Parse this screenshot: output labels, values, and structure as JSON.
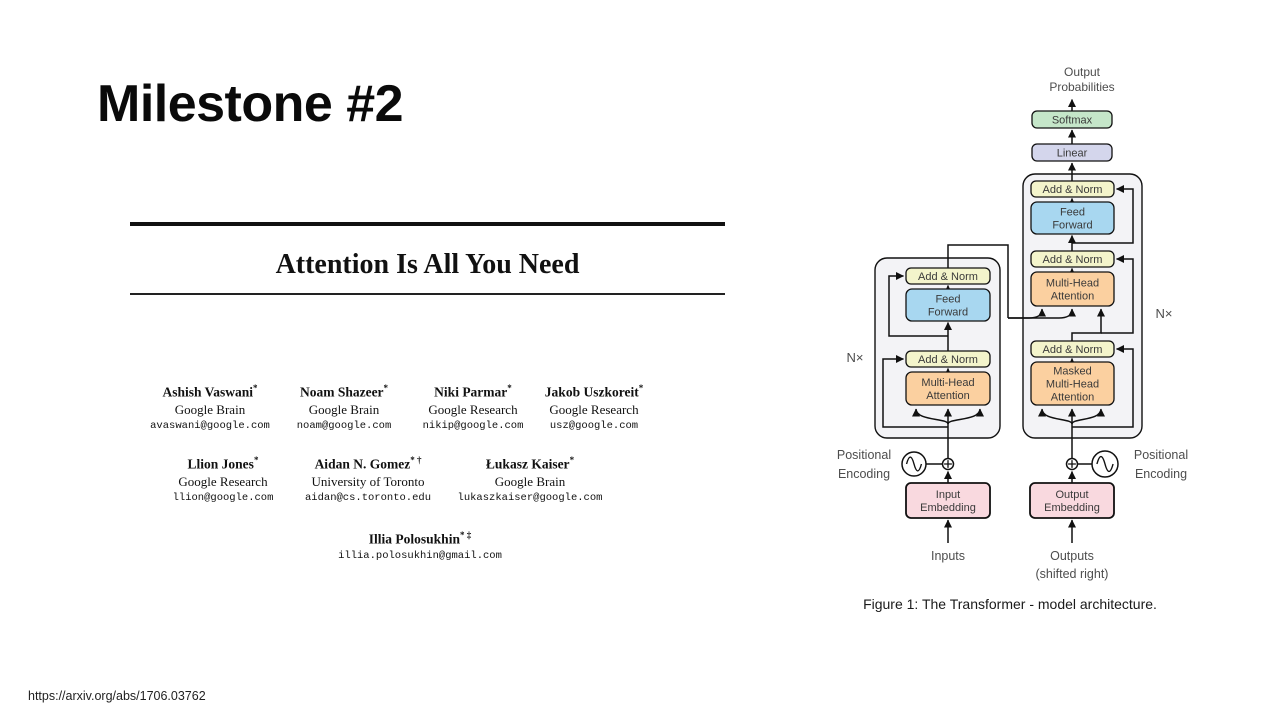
{
  "slide": {
    "title": "Milestone #2",
    "source_url": "https://arxiv.org/abs/1706.03762"
  },
  "paper": {
    "title": "Attention Is All You Need",
    "author_rows": [
      {
        "top": 158,
        "authors": [
          {
            "cx": 80,
            "name": "Ashish Vaswani",
            "sup": "*",
            "affiliation": "Google Brain",
            "email": "avaswani@google.com"
          },
          {
            "cx": 214,
            "name": "Noam Shazeer",
            "sup": "*",
            "affiliation": "Google Brain",
            "email": "noam@google.com"
          },
          {
            "cx": 343,
            "name": "Niki Parmar",
            "sup": "*",
            "affiliation": "Google Research",
            "email": "nikip@google.com"
          },
          {
            "cx": 464,
            "name": "Jakob Uszkoreit",
            "sup": "*",
            "affiliation": "Google Research",
            "email": "usz@google.com"
          }
        ]
      },
      {
        "top": 230,
        "authors": [
          {
            "cx": 93,
            "name": "Llion Jones",
            "sup": "*",
            "affiliation": "Google Research",
            "email": "llion@google.com"
          },
          {
            "cx": 238,
            "name": "Aidan N. Gomez",
            "sup": "* †",
            "affiliation": "University of Toronto",
            "email": "aidan@cs.toronto.edu"
          },
          {
            "cx": 400,
            "name": "Łukasz Kaiser",
            "sup": "*",
            "affiliation": "Google Brain",
            "email": "lukaszkaiser@google.com"
          }
        ]
      },
      {
        "top": 305,
        "authors": [
          {
            "cx": 290,
            "name": "Illia Polosukhin",
            "sup": "* ‡",
            "affiliation": "",
            "email": "illia.polosukhin@gmail.com"
          }
        ]
      }
    ]
  },
  "figure": {
    "caption": "Figure 1: The Transformer - model architecture.",
    "colors": {
      "stroke": "#111111",
      "container": "#f3f3f6",
      "addnorm": "#f3f4cb",
      "feedforward": "#a8d7f0",
      "attention": "#fbd0a0",
      "softmax": "#c5e6c9",
      "linear": "#d4d6ec",
      "embedding": "#f9d9df",
      "label_text": "#4d4d4d",
      "box_text": "#3a3a3a"
    },
    "containers": [
      {
        "name": "encoder-container",
        "x": 875,
        "y": 258,
        "w": 125,
        "h": 180,
        "rx": 12
      },
      {
        "name": "decoder-container",
        "x": 1023,
        "y": 174,
        "w": 119,
        "h": 264,
        "rx": 12
      }
    ],
    "nodes": [
      {
        "name": "softmax-box",
        "x": 1032,
        "y": 111,
        "w": 80,
        "h": 17,
        "rx": 5,
        "fill": "softmax",
        "lines": [
          "Softmax"
        ]
      },
      {
        "name": "linear-box",
        "x": 1032,
        "y": 144,
        "w": 80,
        "h": 17,
        "rx": 5,
        "fill": "linear",
        "lines": [
          "Linear"
        ]
      },
      {
        "name": "decoder-add-norm-top-box",
        "x": 1031,
        "y": 181,
        "w": 83,
        "h": 16,
        "rx": 5,
        "fill": "addnorm",
        "lines": [
          "Add & Norm"
        ]
      },
      {
        "name": "decoder-feed-forward-box",
        "x": 1031,
        "y": 202,
        "w": 83,
        "h": 32,
        "rx": 6,
        "fill": "feedforward",
        "lines": [
          "Feed",
          "Forward"
        ]
      },
      {
        "name": "decoder-add-norm-mid-box",
        "x": 1031,
        "y": 251,
        "w": 83,
        "h": 16,
        "rx": 5,
        "fill": "addnorm",
        "lines": [
          "Add & Norm"
        ]
      },
      {
        "name": "decoder-multi-head-attention-box",
        "x": 1031,
        "y": 272,
        "w": 83,
        "h": 34,
        "rx": 6,
        "fill": "attention",
        "lines": [
          "Multi-Head",
          "Attention"
        ]
      },
      {
        "name": "decoder-add-norm-bottom-box",
        "x": 1031,
        "y": 341,
        "w": 83,
        "h": 16,
        "rx": 5,
        "fill": "addnorm",
        "lines": [
          "Add & Norm"
        ]
      },
      {
        "name": "masked-multi-head-attention-box",
        "x": 1031,
        "y": 362,
        "w": 83,
        "h": 43,
        "rx": 6,
        "fill": "attention",
        "lines": [
          "Masked",
          "Multi-Head",
          "Attention"
        ]
      },
      {
        "name": "encoder-add-norm-top-box",
        "x": 906,
        "y": 268,
        "w": 84,
        "h": 16,
        "rx": 5,
        "fill": "addnorm",
        "lines": [
          "Add & Norm"
        ]
      },
      {
        "name": "encoder-feed-forward-box",
        "x": 906,
        "y": 289,
        "w": 84,
        "h": 32,
        "rx": 6,
        "fill": "feedforward",
        "lines": [
          "Feed",
          "Forward"
        ]
      },
      {
        "name": "encoder-add-norm-bottom-box",
        "x": 906,
        "y": 351,
        "w": 84,
        "h": 16,
        "rx": 5,
        "fill": "addnorm",
        "lines": [
          "Add & Norm"
        ]
      },
      {
        "name": "encoder-multi-head-attention-box",
        "x": 906,
        "y": 372,
        "w": 84,
        "h": 33,
        "rx": 6,
        "fill": "attention",
        "lines": [
          "Multi-Head",
          "Attention"
        ]
      },
      {
        "name": "input-embedding-box",
        "x": 906,
        "y": 483,
        "w": 84,
        "h": 35,
        "rx": 5,
        "fill": "embedding",
        "sw": 1.8,
        "lines": [
          "Input",
          "Embedding"
        ]
      },
      {
        "name": "output-embedding-box",
        "x": 1030,
        "y": 483,
        "w": 84,
        "h": 35,
        "rx": 5,
        "fill": "embedding",
        "sw": 1.8,
        "lines": [
          "Output",
          "Embedding"
        ]
      }
    ],
    "labels": [
      {
        "name": "output-probabilities-label",
        "x": 1082,
        "y": 76,
        "size": 12,
        "lh": 15,
        "lines": [
          "Output",
          "Probabilities"
        ]
      },
      {
        "name": "nx-left-label",
        "x": 855,
        "y": 362,
        "size": 13,
        "lh": 16,
        "lines": [
          "N×"
        ]
      },
      {
        "name": "nx-right-label",
        "x": 1164,
        "y": 318,
        "size": 13,
        "lh": 16,
        "lines": [
          "N×"
        ]
      },
      {
        "name": "positional-encoding-left-label",
        "x": 864,
        "y": 459,
        "size": 12.5,
        "lh": 19,
        "lines": [
          "Positional",
          "Encoding"
        ]
      },
      {
        "name": "positional-encoding-right-label",
        "x": 1161,
        "y": 459,
        "size": 12.5,
        "lh": 19,
        "lines": [
          "Positional",
          "Encoding"
        ]
      },
      {
        "name": "inputs-label",
        "x": 948,
        "y": 560,
        "size": 12.5,
        "lh": 18,
        "lines": [
          "Inputs"
        ]
      },
      {
        "name": "outputs-label",
        "x": 1072,
        "y": 560,
        "size": 12.5,
        "lh": 18,
        "lines": [
          "Outputs",
          "(shifted right)"
        ]
      }
    ],
    "symbols": [
      {
        "name": "positional-encoding-sine-left-icon",
        "type": "sine",
        "cx": 914,
        "cy": 464,
        "r": 12
      },
      {
        "name": "positional-add-left-icon",
        "type": "plus",
        "cx": 948,
        "cy": 464,
        "r": 5.5
      },
      {
        "name": "positional-add-right-icon",
        "type": "plus",
        "cx": 1072,
        "cy": 464,
        "r": 5.5
      },
      {
        "name": "positional-encoding-sine-right-icon",
        "type": "sine",
        "cx": 1105,
        "cy": 464,
        "r": 13
      }
    ]
  }
}
